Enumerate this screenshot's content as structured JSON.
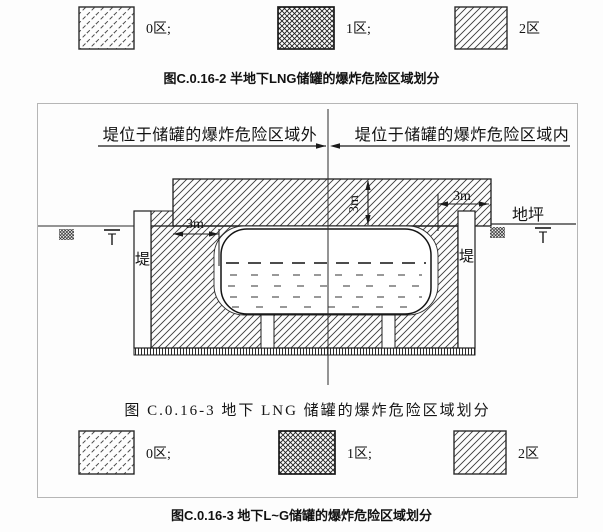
{
  "page": {
    "colors": {
      "ink": "#1c1c1c",
      "frame_border": "#b6b6b6",
      "background": "#fdfdfd"
    }
  },
  "legend_top": {
    "items": [
      {
        "label": "0区;",
        "pattern": "dashed-diagonal-hatch"
      },
      {
        "label": "1区;",
        "pattern": "crosshatch"
      },
      {
        "label": "2区",
        "pattern": "diagonal-hatch"
      }
    ]
  },
  "caption_top": "图C.0.16-2  半地下LNG储罐的爆炸危险区域划分",
  "diagram": {
    "note_left": "堤位于储罐的爆炸危险区域外",
    "note_right": "堤位于储罐的爆炸危险区域内",
    "dim_left": "3m",
    "dim_center": "3m",
    "dim_right": "3m",
    "ground_label": "地坪",
    "dike_left": "堤",
    "dike_right": "堤",
    "caption": "图 C.0.16-3  地下 LNG 储罐的爆炸危险区域划分"
  },
  "legend_bottom": {
    "items": [
      {
        "label": "0区;",
        "pattern": "dashed-diagonal-hatch"
      },
      {
        "label": "1区;",
        "pattern": "crosshatch"
      },
      {
        "label": "2区",
        "pattern": "diagonal-hatch"
      }
    ]
  },
  "caption_bottom": "图C.0.16-3  地下L~G储罐的爆炸危险区域划分"
}
